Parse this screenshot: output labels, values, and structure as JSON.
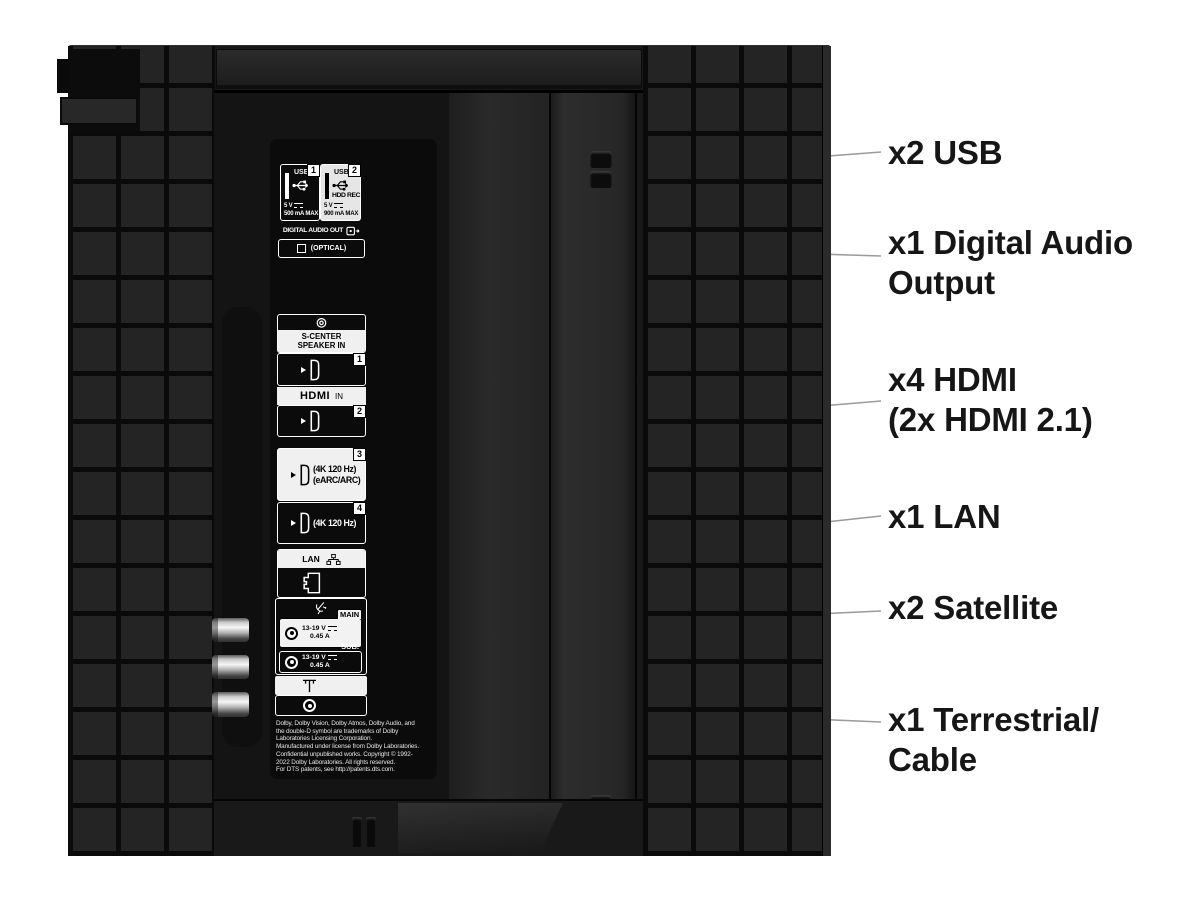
{
  "callouts": [
    {
      "id": "usb",
      "lines": [
        "x2 USB"
      ]
    },
    {
      "id": "digital-audio",
      "lines": [
        "x1 Digital Audio",
        "Output"
      ]
    },
    {
      "id": "hdmi",
      "lines": [
        "x4 HDMI",
        "(2x HDMI 2.1)"
      ]
    },
    {
      "id": "lan",
      "lines": [
        "x1 LAN"
      ]
    },
    {
      "id": "satellite",
      "lines": [
        "x2 Satellite"
      ]
    },
    {
      "id": "terrestrial",
      "lines": [
        "x1 Terrestrial/",
        "Cable"
      ]
    }
  ],
  "panel": {
    "usb": {
      "port1": {
        "badge": "1",
        "label": "USB",
        "volts": "5 V",
        "max": "500 mA MAX"
      },
      "port2": {
        "badge": "2",
        "label": "USB",
        "hdd": "HDD REC",
        "volts": "5 V",
        "max": "900 mA MAX"
      }
    },
    "digital_audio": {
      "title": "DIGITAL AUDIO OUT",
      "optical": "(OPTICAL)"
    },
    "s_center": {
      "line1": "S-CENTER",
      "line2": "SPEAKER IN"
    },
    "hdmi": {
      "logo": "HDMI",
      "in_label": "IN",
      "p1": "1",
      "p2": "2",
      "p3": "3",
      "p4": "4",
      "port3_line1": "(4K 120 Hz)",
      "port3_line2": "(eARC/ARC)",
      "port4_line1": "(4K 120 Hz)"
    },
    "lan": {
      "label": "LAN"
    },
    "satellite": {
      "main_label": "MAIN",
      "main_volts": "13-19 V",
      "main_amps": "0.45 A",
      "sub_label": "SUB.",
      "sub_volts": "13-19 V",
      "sub_amps": "0.45 A"
    },
    "legal": [
      "Dolby, Dolby Vision, Dolby Atmos, Dolby Audio, and",
      "the double-D symbol are trademarks of Dolby",
      "Laboratories Licensing Corporation.",
      "Manufactured under license from Dolby Laboratories.",
      "Confidential unpublished works. Copyright © 1992-",
      "2022 Dolby Laboratories. All rights reserved.",
      "For DTS patents, see http://patents.dts.com."
    ]
  },
  "colors": {
    "background": "#ffffff",
    "tv_body": "#181818",
    "tile": "#242424",
    "tile_gap": "#0a0a0a",
    "port_panel": "#0b0b0b",
    "box_white": "#f0f0f0",
    "callout_line": "#9c9c9c",
    "label_text": "#161616"
  }
}
